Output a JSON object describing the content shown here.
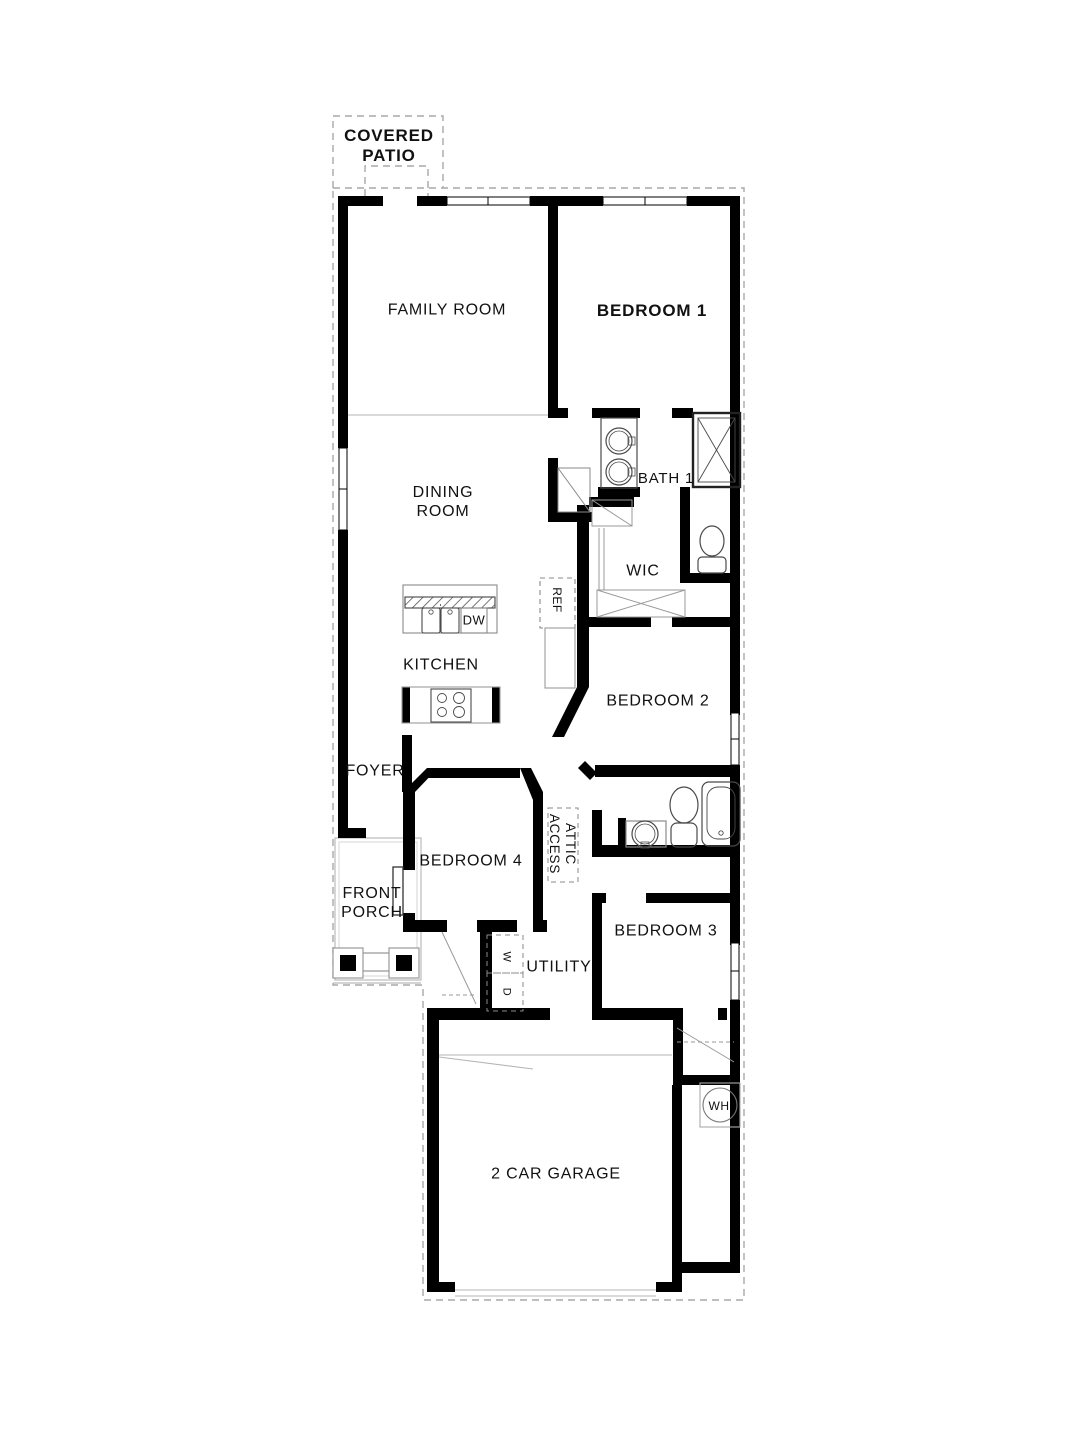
{
  "plan": {
    "rooms": {
      "covered_patio": "COVERED PATIO",
      "family_room": "FAMILY ROOM",
      "bedroom_1": "BEDROOM 1",
      "bath_1": "BATH 1",
      "wic": "WIC",
      "dining_room": "DINING ROOM",
      "kitchen": "KITCHEN",
      "bedroom_2": "BEDROOM 2",
      "foyer": "FOYER",
      "attic_access": "ATTIC ACCESS",
      "bedroom_4": "BEDROOM 4",
      "front_porch": "FRONT PORCH",
      "utility": "UTILITY",
      "bedroom_3": "BEDROOM 3",
      "garage": "2 CAR GARAGE"
    },
    "appliances": {
      "refrigerator": "REF",
      "dishwasher": "DW",
      "washer": "W",
      "dryer": "D",
      "water_heater": "WH"
    },
    "colors": {
      "wall": "#000000",
      "fixture_line": "#4a4a4a",
      "light_line": "#aaaaaa",
      "text": "#111111",
      "background": "#ffffff"
    }
  }
}
